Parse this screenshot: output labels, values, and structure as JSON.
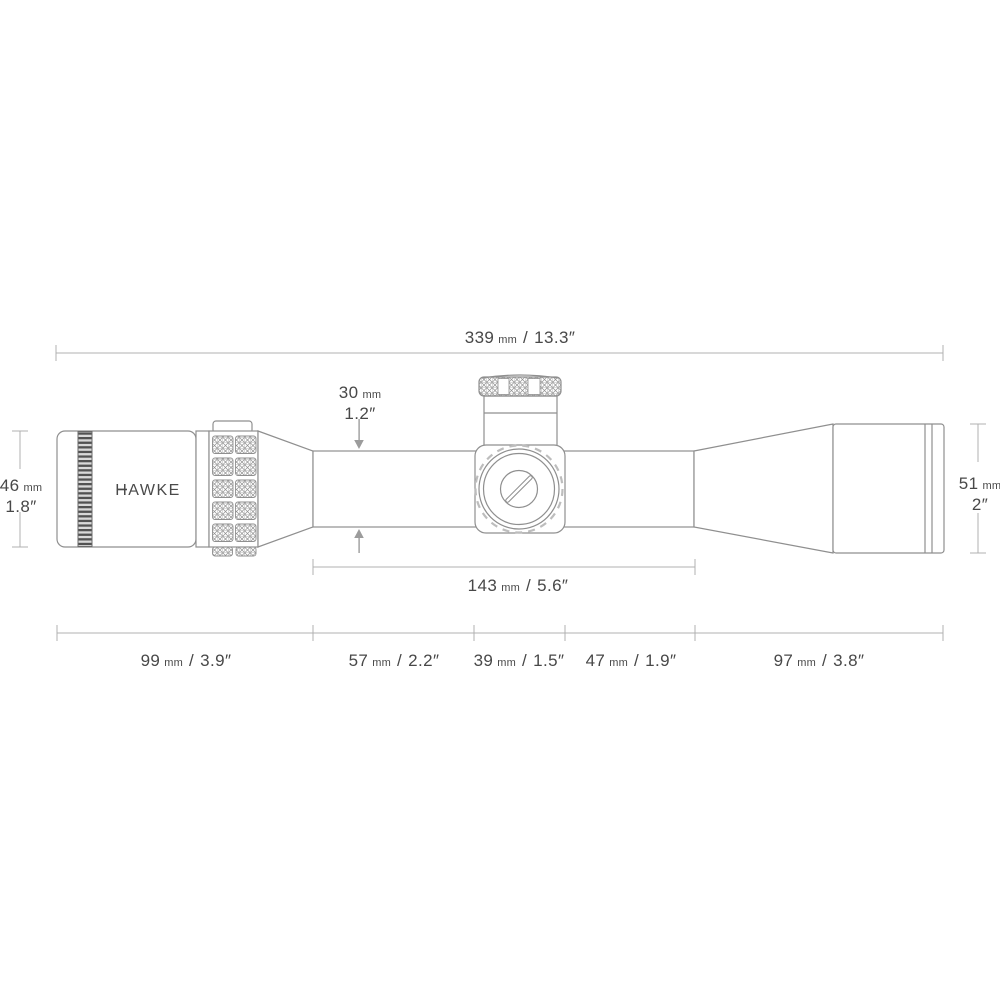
{
  "title": "Riflescope dimension diagram",
  "brand": {
    "logo": "HAWKE"
  },
  "units": {
    "mm": "mm",
    "divider": "/"
  },
  "dims": {
    "overall": {
      "mm": "339",
      "in": "13.3″"
    },
    "tube": {
      "mm": "30",
      "in": "1.2″"
    },
    "eyepiece": {
      "mm": "46",
      "in": "1.8″"
    },
    "objective": {
      "mm": "51",
      "in": "2″"
    },
    "saddle_span": {
      "mm": "143",
      "in": "5.6″"
    },
    "segments": [
      {
        "mm": "99",
        "in": "3.9″"
      },
      {
        "mm": "57",
        "in": "2.2″"
      },
      {
        "mm": "39",
        "in": "1.5″"
      },
      {
        "mm": "47",
        "in": "1.9″"
      },
      {
        "mm": "97",
        "in": "3.8″"
      }
    ]
  },
  "colors": {
    "drawing_line": "#8f8f8f",
    "dimension_line": "#b0b0b0",
    "text": "#484848",
    "arrow": "#9c9c9c"
  }
}
